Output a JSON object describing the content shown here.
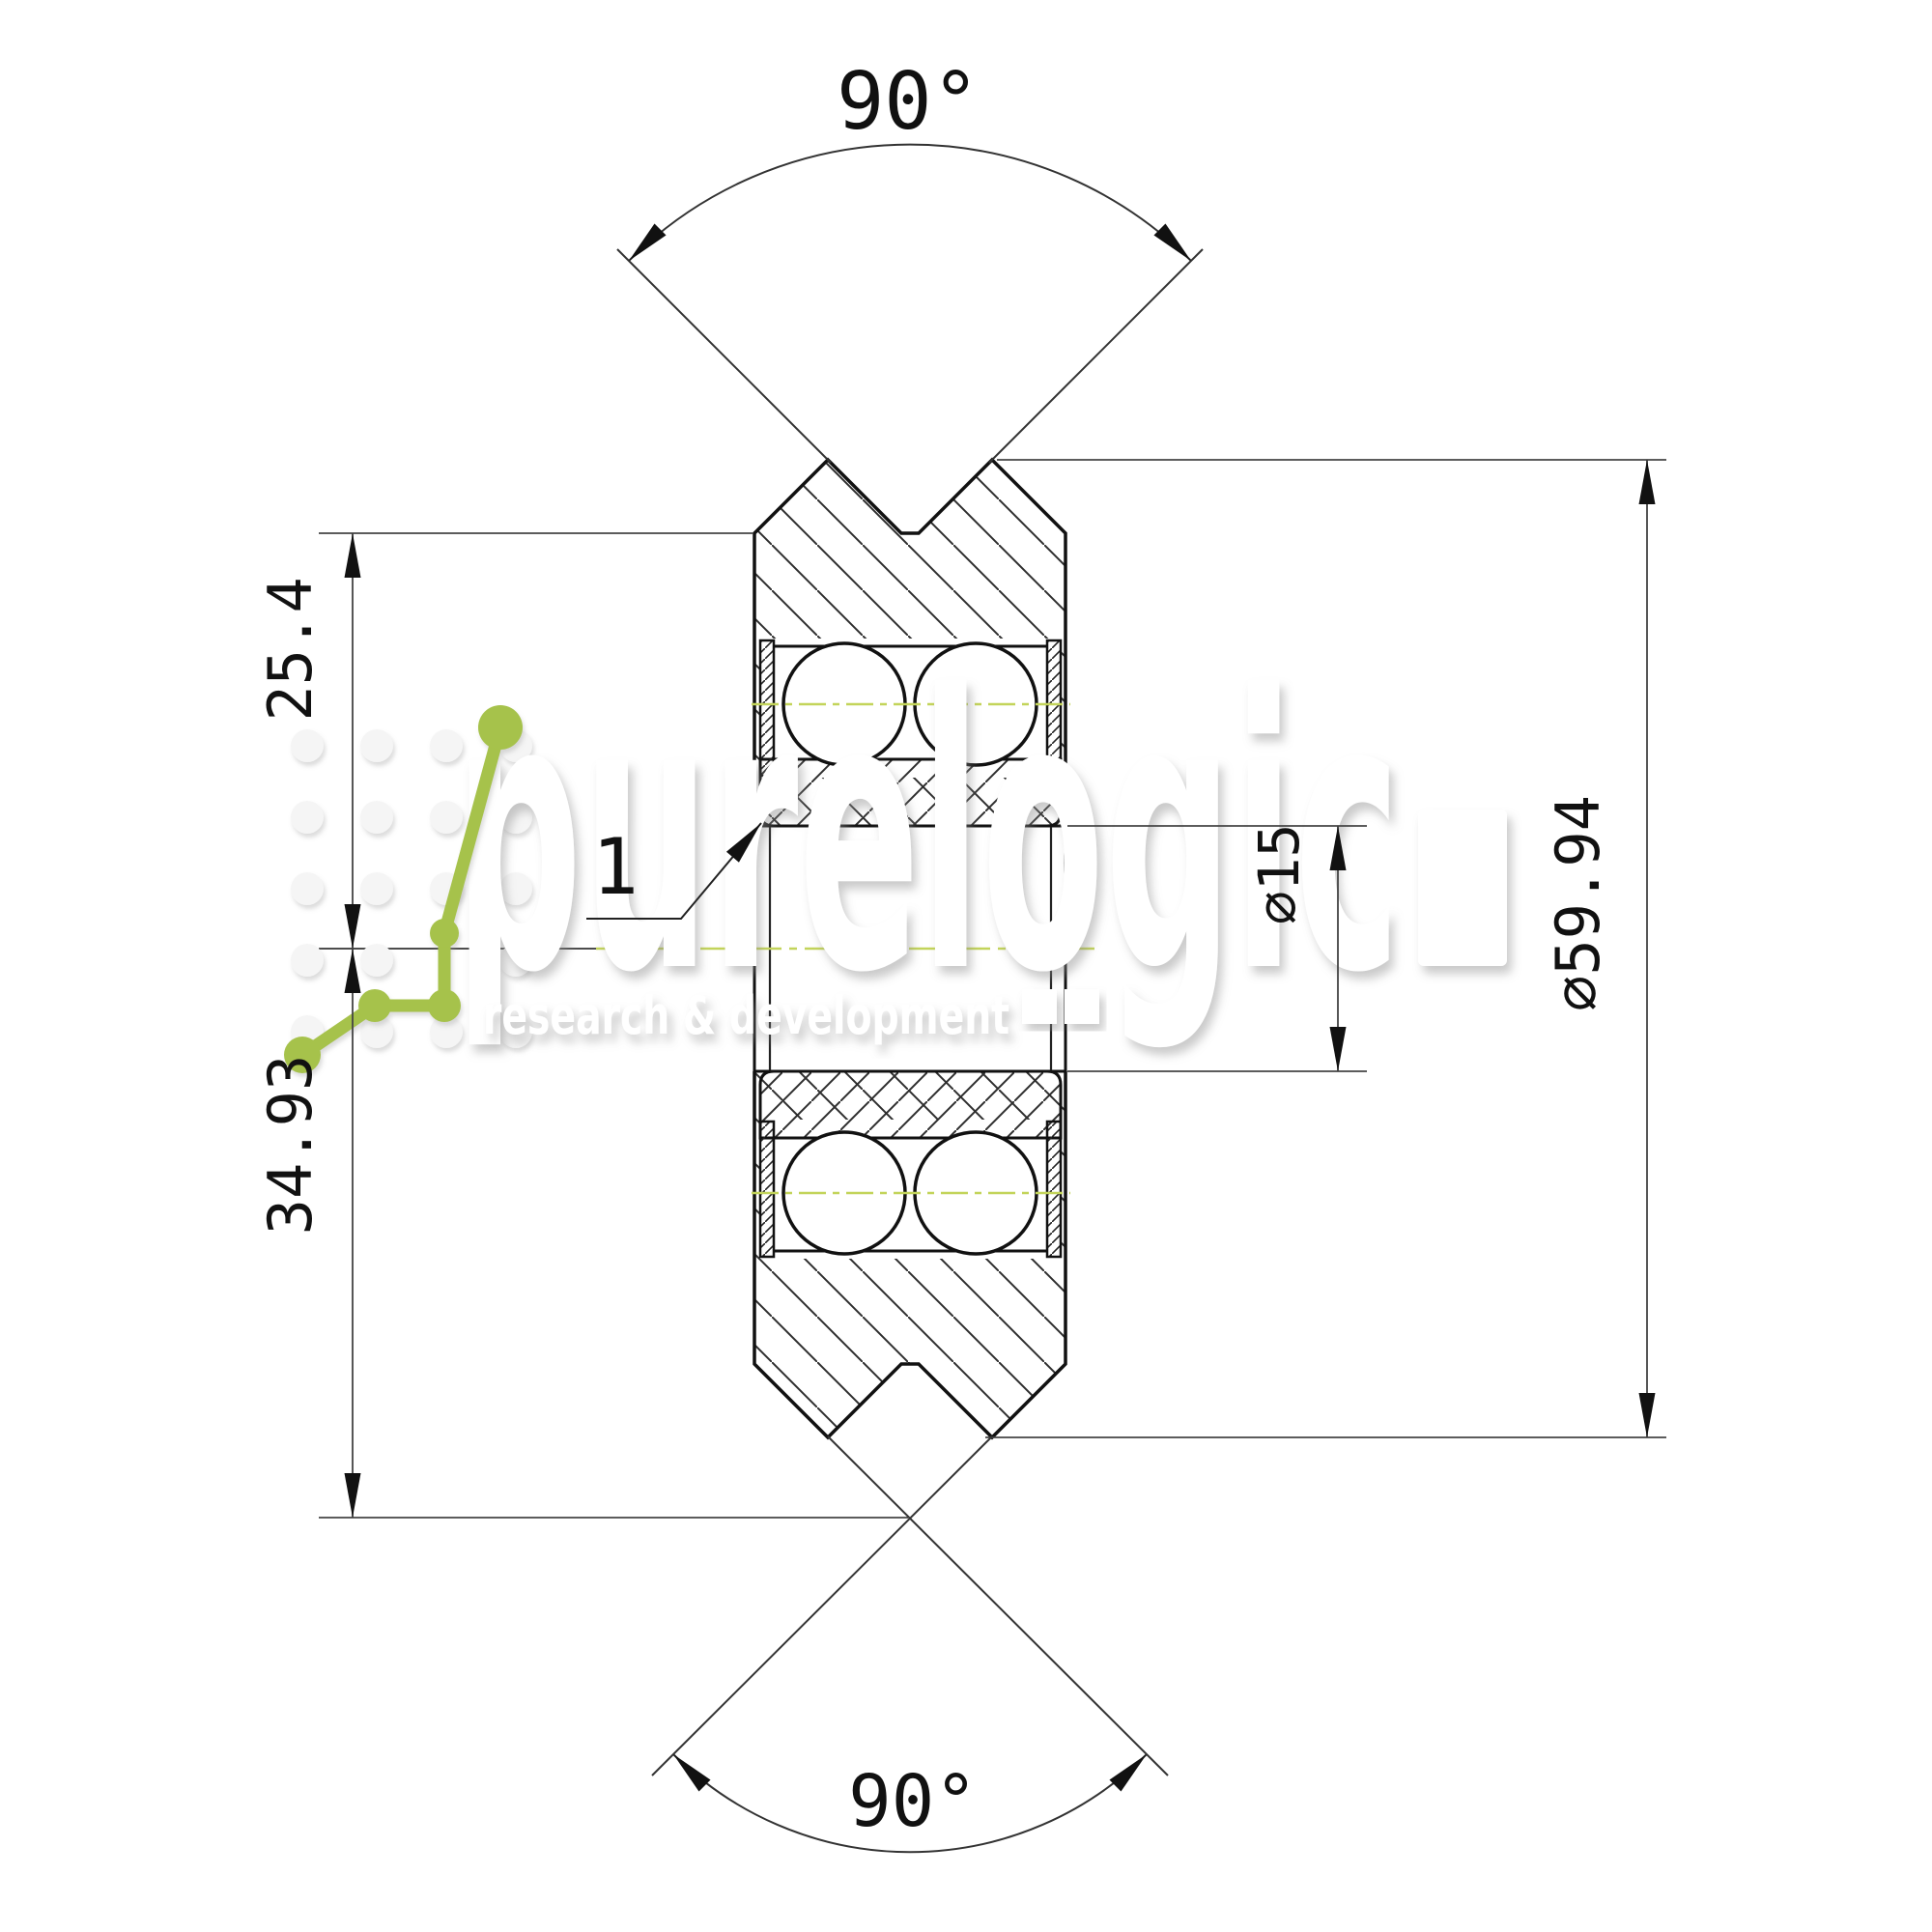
{
  "drawing": {
    "part_label": "1",
    "angle_top": "90°",
    "angle_bottom": "90°",
    "dim_flange_radius": "25.4",
    "dim_lower_radius": "34.93",
    "dim_bore": "⌀15",
    "dim_outer_diameter": "⌀59.94"
  },
  "watermark": {
    "brand": "purelogic",
    "tagline": "research & development"
  },
  "colors": {
    "line_black": "#1a1a1a",
    "thin_line": "#444444",
    "centerline_green": "#c3d45a",
    "logo_green": "#a6c24b",
    "dot_gray": "#f5f5f5"
  }
}
